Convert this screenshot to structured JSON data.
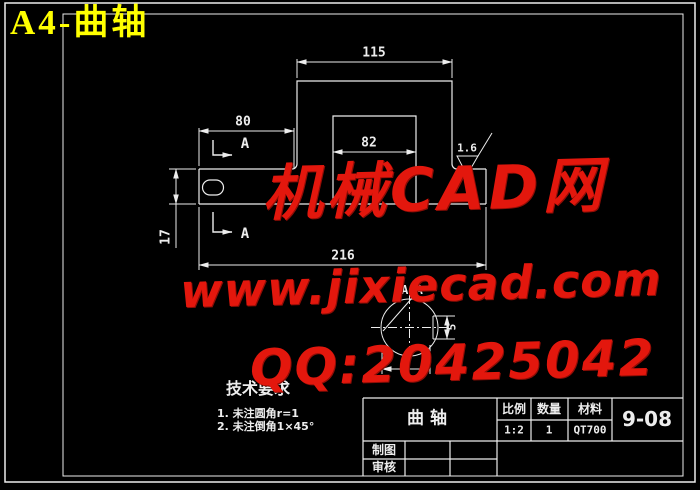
{
  "sheet": {
    "corner_label": "A4-曲轴"
  },
  "drawing": {
    "dims": {
      "boss_width": "115",
      "left_section": "80",
      "pin_width": "82",
      "total_length": "216",
      "shaft_height": "17",
      "roughness": "1.6",
      "keyway_width": "5",
      "section_dia_fragment": "2"
    },
    "section": {
      "marker": "A",
      "view_label": "A-A"
    },
    "tech": {
      "heading": "技术要求",
      "item1": "1. 未注圆角r=1",
      "item2": "2. 未注倒角1×45°"
    }
  },
  "title_block": {
    "part_name": "曲轴",
    "scale_label": "比例",
    "scale_value": "1:2",
    "qty_label": "数量",
    "qty_value": "1",
    "material_label": "材料",
    "material_value": "QT700",
    "drawing_no": "9-08",
    "drafter_label": "制图",
    "checker_label": "审核"
  },
  "watermark": {
    "line1": "机械CAD网",
    "line2": "www.jixiecad.com",
    "line3": "QQ:20425042"
  },
  "colors": {
    "background": "#000000",
    "line": "#ededed",
    "corner_title": "#ffff00",
    "watermark": "#e3170d"
  }
}
